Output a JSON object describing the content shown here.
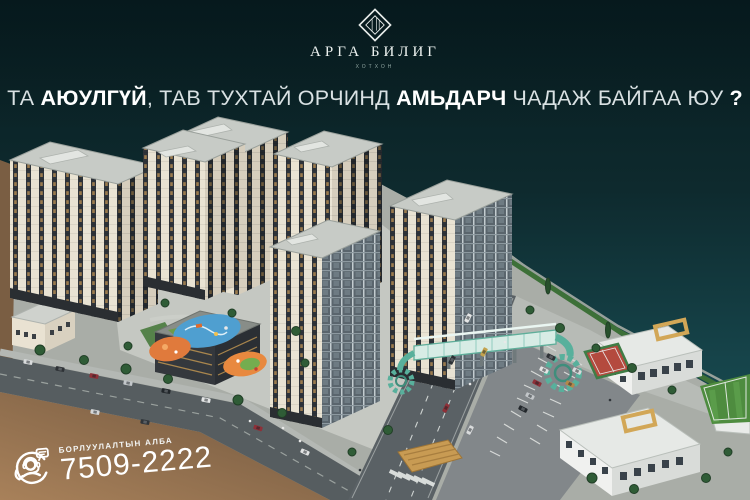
{
  "brand": {
    "name": "АРГА БИЛИГ",
    "tagline": "ХОТХОН",
    "logo_icon": "diamond-monogram-icon"
  },
  "headline": {
    "full_text": "ТА АЮУЛГҮЙ, ТАВ ТУХТАЙ ОРЧИНД АМЬДАРЧ ЧАДАЖ БАЙГАА ЮУ ?",
    "segments": [
      {
        "text": "ТА ",
        "bold": false
      },
      {
        "text": "АЮУЛГҮЙ",
        "bold": true
      },
      {
        "text": ", ТАВ ТУХТАЙ ОРЧИНД ",
        "bold": false
      },
      {
        "text": "АМЬДАРЧ",
        "bold": true
      },
      {
        "text": " ЧАДАЖ БАЙГАА ЮУ ",
        "bold": false
      },
      {
        "text": "?",
        "bold": true
      }
    ]
  },
  "contact": {
    "department": "БОРЛУУЛАЛТЫН АЛБА",
    "phone": "7509-2222",
    "icon": "call-center-agent-icon"
  },
  "scene": {
    "type": "aerial-3d-masterplan-render",
    "elements": [
      "riverfront-water",
      "apartment-towers",
      "courtyard-playgrounds",
      "commercial-podium-building",
      "retail-building",
      "main-street",
      "avenue",
      "pedestrian-bridge-with-spiral-ramps",
      "parking-lot",
      "school-buildings",
      "basketball-court",
      "football-field",
      "wooden-pavilion",
      "vacant-dirt-lot",
      "embankment-promenade",
      "trees",
      "cars"
    ]
  },
  "colors": {
    "background_teal": "#0d2527",
    "water_deep": "#0a2023",
    "water_shore": "#1b5054",
    "dirt_brown": "#8a6a4b",
    "facade_ivory": "#e9e3d3",
    "window_dark": "#2e3339",
    "roof_gray": "#c7cbc6",
    "bridge_green": "#57b49e",
    "court_red": "#b44a3e",
    "field_green": "#4e8c3f",
    "wood_tan": "#c89b53",
    "text_white": "#ffffff"
  }
}
